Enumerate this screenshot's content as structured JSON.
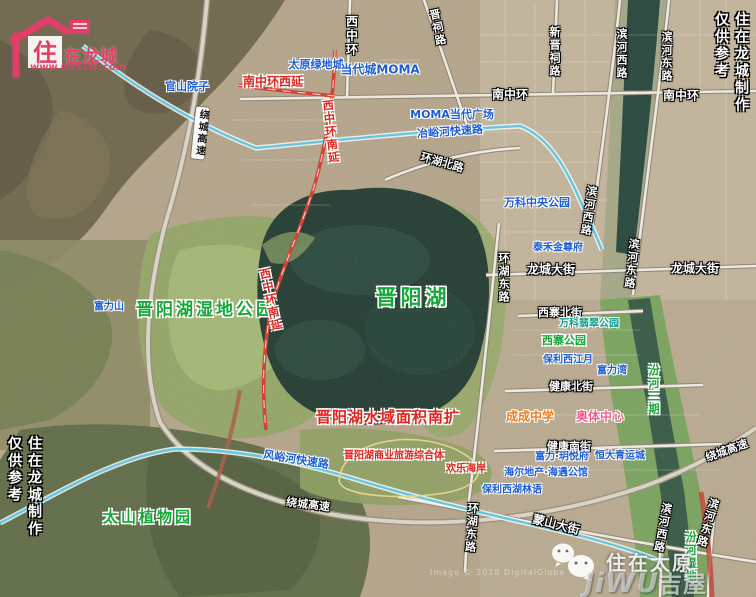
{
  "colors": {
    "blue": "#1d5dd3",
    "green": "#17a83a",
    "teal": "#0a9e8c",
    "red": "#e2251f",
    "orange": "#f07c17",
    "pink": "#f0608d",
    "logo_pink": "#e23f68",
    "lake": "#20392f"
  },
  "branding": {
    "logo_house_char": "住",
    "logo_brand": "在龙城",
    "logo_url": "www.0351fc.com",
    "side_line1": "住在龙城制作",
    "side_line2": "仅供参考",
    "wechat_name": "住在太原",
    "jiwu_latin": "JiWU",
    "jiwu_cn": "吉屋",
    "attribution": "Image © 2018 DigitalGlobe"
  },
  "map": {
    "labels": [
      {
        "n": "road-xizhonghuan",
        "t": "西中环",
        "x": 351,
        "y": 36,
        "cls": "road",
        "vert": 1,
        "fs": 12
      },
      {
        "n": "road-jinci-lu",
        "t": "晋祠路",
        "x": 437,
        "y": 28,
        "cls": "road",
        "vert": 1,
        "rot": -12,
        "fs": 11
      },
      {
        "n": "road-xinjinci-lu",
        "t": "新晋祠路",
        "x": 554,
        "y": 52,
        "cls": "road",
        "vert": 1,
        "fs": 11
      },
      {
        "n": "road-binhe-xilu-north",
        "t": "滨河西路",
        "x": 621,
        "y": 54,
        "cls": "road",
        "vert": 1,
        "fs": 11
      },
      {
        "n": "road-binhe-donglu-north",
        "t": "滨河东路",
        "x": 666,
        "y": 57,
        "cls": "road",
        "vert": 1,
        "fs": 11
      },
      {
        "n": "estate-taiyuan-ludicheng",
        "t": "太原绿地城",
        "x": 316,
        "y": 65,
        "cls": "blue",
        "fs": 11
      },
      {
        "n": "estate-dangdaicheng-moma",
        "t": "当代城MOMA",
        "x": 380,
        "y": 70,
        "cls": "blue",
        "fs": 12
      },
      {
        "n": "road-nanzhonghuan-xiyan",
        "t": "南中环西延",
        "x": 273,
        "y": 82,
        "cls": "red",
        "fs": 12
      },
      {
        "n": "estate-guanshan-yuanzi",
        "t": "官山院子",
        "x": 187,
        "y": 87,
        "cls": "blue",
        "fs": 11
      },
      {
        "n": "road-nanzhonghuan-center",
        "t": "南中环",
        "x": 510,
        "y": 95,
        "cls": "road",
        "fs": 12
      },
      {
        "n": "road-nanzhonghuan-right",
        "t": "南中环",
        "x": 681,
        "y": 96,
        "cls": "road",
        "fs": 12
      },
      {
        "n": "estate-moma-plaza",
        "t": "MOMA当代广场",
        "x": 452,
        "y": 115,
        "cls": "blue",
        "fs": 11
      },
      {
        "n": "road-yeyuhe-expressway",
        "t": "冶峪河快速路",
        "x": 450,
        "y": 132,
        "cls": "blue",
        "fs": 11,
        "rot": -4
      },
      {
        "n": "road-raocheng-gaosu-nw",
        "t": "绕城高速",
        "x": 200,
        "y": 133,
        "cls": "roadbox",
        "vert": 1,
        "rot": 6,
        "fs": 10
      },
      {
        "n": "road-xizhonghuan-nanyan-n",
        "t": "西中环南延",
        "x": 330,
        "y": 132,
        "cls": "red",
        "vert": 1,
        "rot": -6,
        "fs": 11
      },
      {
        "n": "road-huanhu-beilu",
        "t": "环湖北路",
        "x": 442,
        "y": 163,
        "cls": "road",
        "fs": 11,
        "rot": 16
      },
      {
        "n": "park-wanke-zhongyang",
        "t": "万科中央公园",
        "x": 537,
        "y": 203,
        "cls": "blue",
        "fs": 11
      },
      {
        "n": "road-binhe-xilu-mid",
        "t": "滨河西路",
        "x": 588,
        "y": 211,
        "cls": "road",
        "vert": 1,
        "rot": 8,
        "fs": 11
      },
      {
        "n": "estate-taihe-jinzunfu",
        "t": "泰禾金尊府",
        "x": 558,
        "y": 249,
        "cls": "blue",
        "fs": 10
      },
      {
        "n": "road-longcheng-dajie-left",
        "t": "龙城大街",
        "x": 551,
        "y": 270,
        "cls": "road",
        "fs": 12
      },
      {
        "n": "road-longcheng-dajie-right",
        "t": "龙城大街",
        "x": 695,
        "y": 269,
        "cls": "road",
        "fs": 12
      },
      {
        "n": "road-binhe-donglu-mid",
        "t": "滨河东路",
        "x": 631,
        "y": 264,
        "cls": "road",
        "vert": 1,
        "rot": 6,
        "fs": 11
      },
      {
        "n": "road-huanhu-donglu-north",
        "t": "环湖东路",
        "x": 503,
        "y": 278,
        "cls": "road",
        "vert": 1,
        "fs": 11
      },
      {
        "n": "lake-jinyang",
        "t": "晋阳湖",
        "x": 413,
        "y": 298,
        "cls": "green",
        "fs": 21,
        "ls": 4
      },
      {
        "n": "park-jinyanghu-shidi",
        "t": "晋阳湖湿地公园",
        "x": 206,
        "y": 310,
        "cls": "green",
        "fs": 17,
        "ls": 3
      },
      {
        "n": "estate-fulishan",
        "t": "富力山",
        "x": 109,
        "y": 308,
        "cls": "blue",
        "fs": 10
      },
      {
        "n": "road-xizhonghuan-nanyan-s",
        "t": "西中环南延",
        "x": 270,
        "y": 300,
        "cls": "red",
        "vert": 1,
        "rot": -12,
        "fs": 11
      },
      {
        "n": "road-xizhai-beijie",
        "t": "西寨北街",
        "x": 560,
        "y": 313,
        "cls": "road",
        "fs": 11
      },
      {
        "n": "park-wanke-feicui",
        "t": "万科翡翠公园",
        "x": 589,
        "y": 325,
        "cls": "teal",
        "fs": 10
      },
      {
        "n": "park-xizhai",
        "t": "西寨公园",
        "x": 564,
        "y": 341,
        "cls": "green2",
        "fs": 11
      },
      {
        "n": "estate-baoli-xijiangyue",
        "t": "保利西江月",
        "x": 568,
        "y": 361,
        "cls": "blue",
        "fs": 10
      },
      {
        "n": "estate-fuliwan",
        "t": "富力湾",
        "x": 612,
        "y": 372,
        "cls": "blue",
        "fs": 10
      },
      {
        "n": "road-jiankang-beijie",
        "t": "健康北街",
        "x": 571,
        "y": 387,
        "cls": "road",
        "fs": 11
      },
      {
        "n": "river-fenhe-sanqi",
        "t": "汾河三期",
        "x": 653,
        "y": 390,
        "cls": "green2",
        "vert": 1,
        "fs": 11
      },
      {
        "n": "school-chengcheng",
        "t": "成成中学",
        "x": 530,
        "y": 417,
        "cls": "orange",
        "fs": 12
      },
      {
        "n": "venue-aoti-zhongxin",
        "t": "奥体中心",
        "x": 600,
        "y": 417,
        "cls": "pink",
        "fs": 12
      },
      {
        "n": "anno-lake-south-expand",
        "t": "晋阳湖水域面积南扩",
        "x": 388,
        "y": 417,
        "cls": "red",
        "fs": 15,
        "ls": 1
      },
      {
        "n": "anno-business-tourism-complex",
        "t": "晋阳湖商业旅游综合体",
        "x": 394,
        "y": 457,
        "cls": "red",
        "fs": 10
      },
      {
        "n": "anno-huanle-haian",
        "t": "欢乐海岸",
        "x": 466,
        "y": 470,
        "cls": "red",
        "fs": 10
      },
      {
        "n": "road-fengyuhe-expressway",
        "t": "风峪河快速路",
        "x": 296,
        "y": 460,
        "cls": "blue",
        "fs": 11,
        "rot": 9
      },
      {
        "n": "road-jiankang-nanjie",
        "t": "健康南街",
        "x": 569,
        "y": 447,
        "cls": "road",
        "fs": 11
      },
      {
        "n": "estate-fuli-yueyuefu",
        "t": "富力·玥悦府",
        "x": 562,
        "y": 458,
        "cls": "blue",
        "fs": 10
      },
      {
        "n": "estate-hengda-qingyuncheng",
        "t": "恒大青运城",
        "x": 620,
        "y": 457,
        "cls": "blue",
        "fs": 10
      },
      {
        "n": "estate-haier-haiyu",
        "t": "海尔地产·海遇公馆",
        "x": 546,
        "y": 474,
        "cls": "blue",
        "fs": 10
      },
      {
        "n": "estate-baoli-xihu-linyu",
        "t": "保利西湖林语",
        "x": 512,
        "y": 491,
        "cls": "blue",
        "fs": 10
      },
      {
        "n": "road-raocheng-gaosu-south",
        "t": "绕城高速",
        "x": 308,
        "y": 505,
        "cls": "road",
        "fs": 11,
        "rot": 7
      },
      {
        "n": "road-raocheng-gaosu-east",
        "t": "绕城高速",
        "x": 727,
        "y": 451,
        "cls": "road",
        "fs": 11,
        "rot": -20
      },
      {
        "n": "park-taishan-zhiwuyuan",
        "t": "太山植物园",
        "x": 148,
        "y": 517,
        "cls": "green",
        "fs": 15,
        "ls": 3
      },
      {
        "n": "road-huanhu-donglu-south",
        "t": "环湖东路",
        "x": 471,
        "y": 528,
        "cls": "road",
        "vert": 1,
        "rot": 4,
        "fs": 11
      },
      {
        "n": "road-mengshan-dajie",
        "t": "蒙山大街",
        "x": 556,
        "y": 525,
        "cls": "road",
        "fs": 12,
        "rot": 14
      },
      {
        "n": "road-binhe-xilu-south",
        "t": "滨河西路",
        "x": 662,
        "y": 528,
        "cls": "road",
        "vert": 1,
        "rot": 10,
        "fs": 11
      },
      {
        "n": "road-binhe-donglu-south",
        "t": "滨河东路",
        "x": 707,
        "y": 523,
        "cls": "road",
        "vert": 1,
        "rot": 16,
        "fs": 11
      },
      {
        "n": "river-fenhe-shidi",
        "t": "汾河湿地",
        "x": 690,
        "y": 557,
        "cls": "green2",
        "vert": 1,
        "fs": 11
      }
    ]
  }
}
